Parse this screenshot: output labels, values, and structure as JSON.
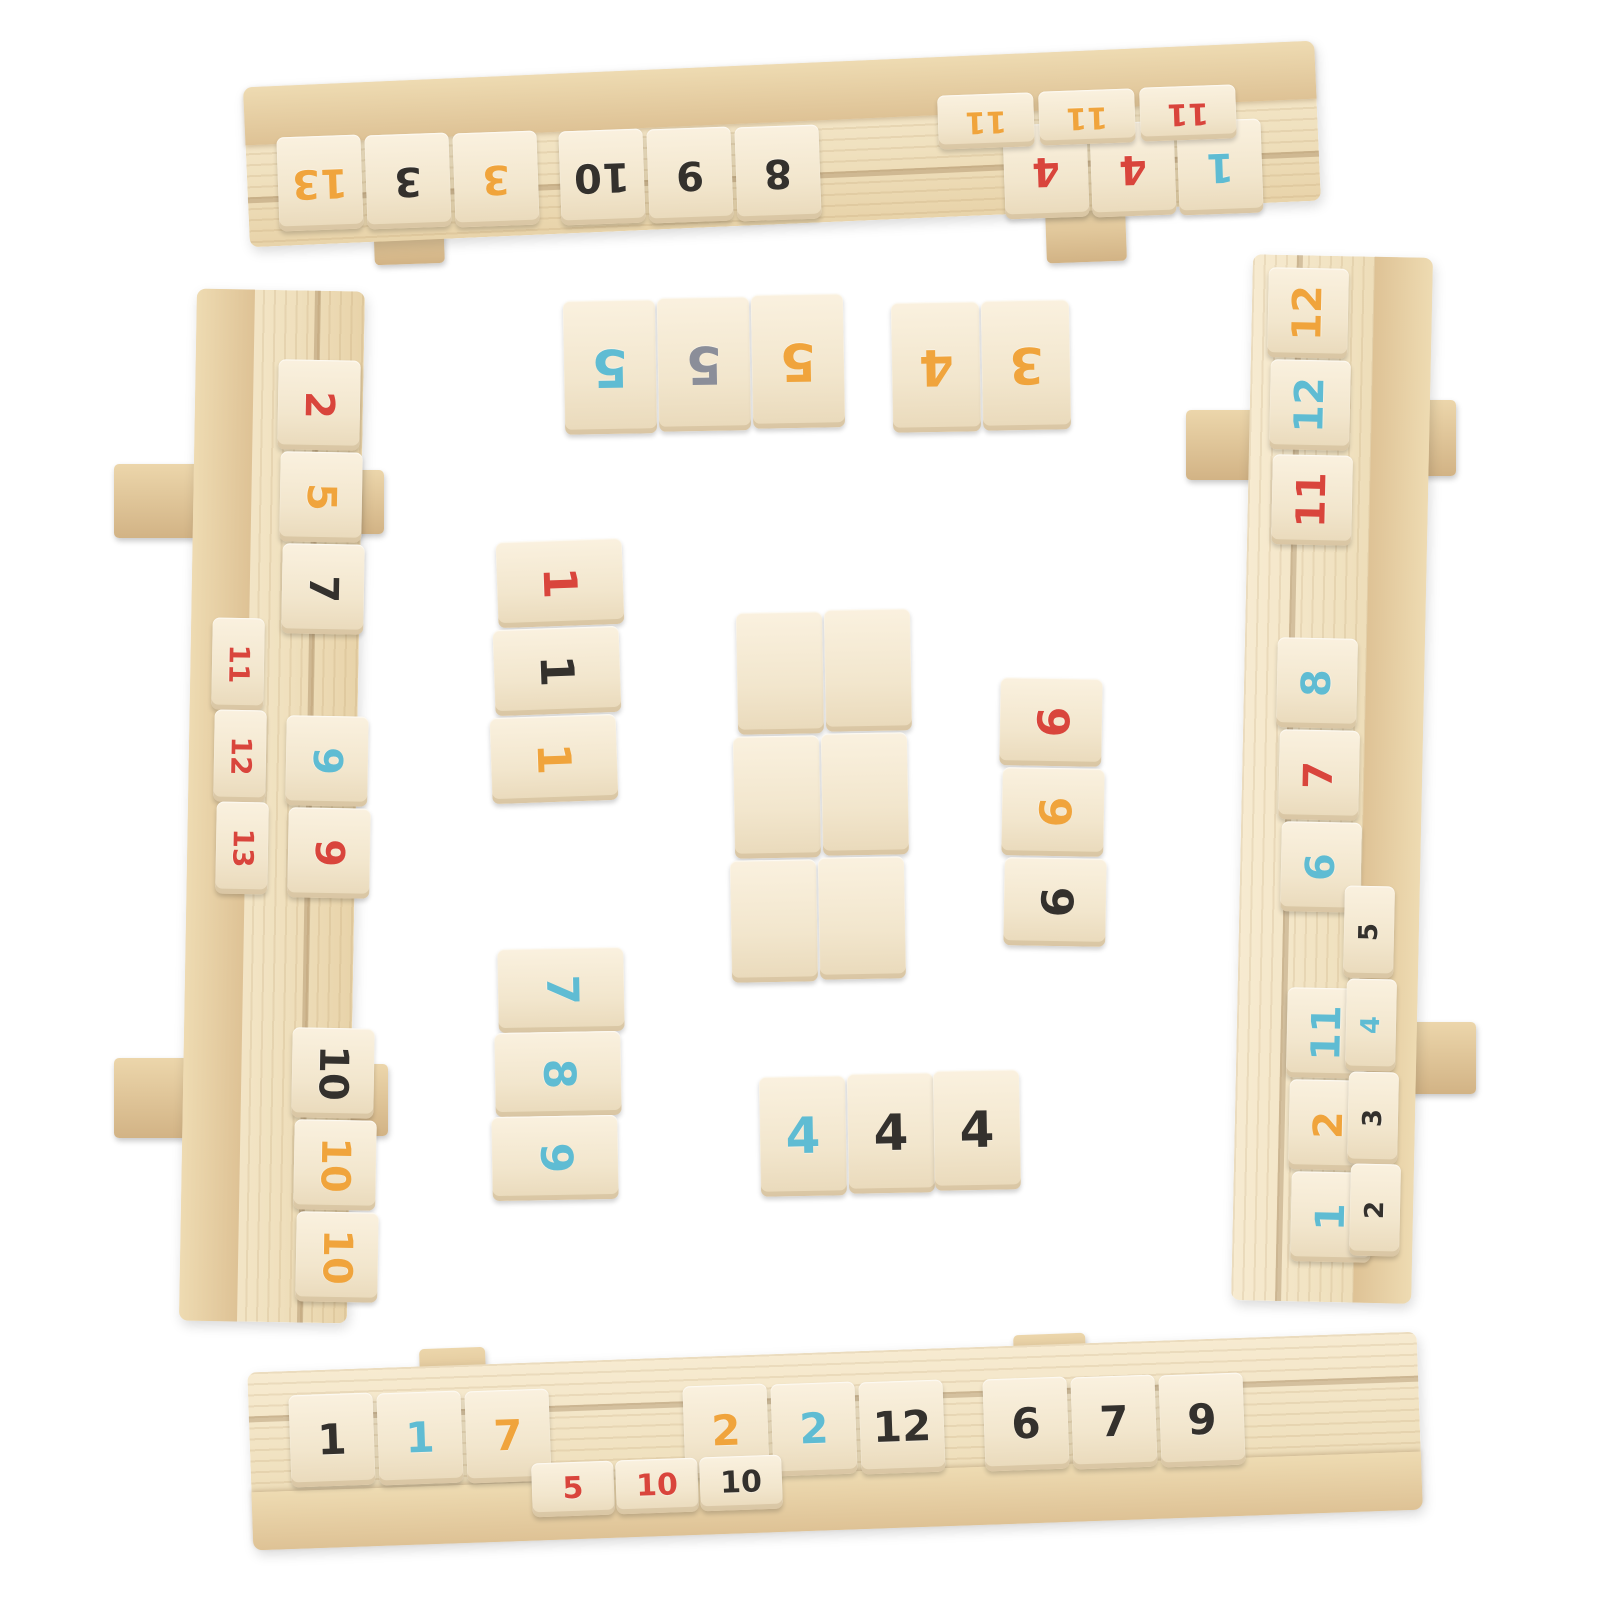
{
  "title": "Wooden Rummikub-style number tile game set - four wooden racks with colored number tiles and tile groups in the center",
  "scene": {
    "width": 1600,
    "height": 1600,
    "background": "#ffffff"
  },
  "palette": {
    "red": "#d9453c",
    "orange": "#f0a43c",
    "blue": "#5fbcd3",
    "black": "#34312d",
    "gray": "#8b8e99",
    "tile": "#f4e9d2",
    "wood": "#f0e1bf",
    "woodDark": "#dec295"
  },
  "boards": [
    {
      "name": "top-rack",
      "kind": "ht",
      "x": 246,
      "y": 64,
      "w": 1072,
      "h": 160,
      "rot": -2.5
    },
    {
      "name": "left-rack",
      "kind": "vl",
      "x": 188,
      "y": 290,
      "w": 168,
      "h": 1032,
      "rot": 1
    },
    {
      "name": "right-rack",
      "kind": "vr",
      "x": 1242,
      "y": 256,
      "w": 180,
      "h": 1046,
      "rot": 1.2
    },
    {
      "name": "bottom-rack",
      "kind": "hb",
      "x": 250,
      "y": 1352,
      "w": 1170,
      "h": 178,
      "rot": -2
    }
  ],
  "feet": [
    [
      374,
      216,
      70,
      48,
      -2
    ],
    [
      1046,
      208,
      80,
      54,
      -2
    ],
    [
      114,
      464,
      86,
      74,
      0
    ],
    [
      352,
      470,
      32,
      64,
      0
    ],
    [
      114,
      1058,
      84,
      80,
      0
    ],
    [
      344,
      1064,
      44,
      72,
      0
    ],
    [
      1186,
      410,
      80,
      70,
      0
    ],
    [
      1404,
      400,
      52,
      76,
      0
    ],
    [
      1404,
      1022,
      72,
      72,
      0
    ],
    [
      420,
      1348,
      66,
      60,
      -2
    ],
    [
      1014,
      1334,
      72,
      54,
      -2
    ]
  ],
  "tileGroups": [
    {
      "name": "top-rack-row",
      "w": 84,
      "h": 94,
      "rot": -2,
      "numRot": 180,
      "fontSize": 40,
      "tiles": [
        [
          "13",
          "orange",
          278,
          136
        ],
        [
          "3",
          "black",
          366,
          134
        ],
        [
          "3",
          "orange",
          454,
          132
        ],
        [
          "10",
          "black",
          560,
          130
        ],
        [
          "9",
          "black",
          648,
          128
        ],
        [
          "8",
          "black",
          736,
          126
        ],
        [
          "4",
          "red",
          1004,
          124
        ],
        [
          "4",
          "red",
          1091,
          122
        ],
        [
          "1",
          "blue",
          1178,
          120
        ]
      ]
    },
    {
      "name": "top-rack-ledge",
      "w": 96,
      "h": 54,
      "rot": -2,
      "numRot": 180,
      "fontSize": 30,
      "tiles": [
        [
          "11",
          "orange",
          938,
          94
        ],
        [
          "11",
          "orange",
          1039,
          90
        ],
        [
          "11",
          "red",
          1140,
          86
        ]
      ]
    },
    {
      "name": "left-rack-row",
      "w": 82,
      "h": 90,
      "rot": 1,
      "numRot": 90,
      "fontSize": 40,
      "tiles": [
        [
          "2",
          "red",
          278,
          360
        ],
        [
          "5",
          "orange",
          280,
          452
        ],
        [
          "7",
          "black",
          282,
          544
        ],
        [
          "9",
          "blue",
          286,
          716
        ],
        [
          "9",
          "red",
          288,
          808
        ],
        [
          "10",
          "black",
          292,
          1028
        ],
        [
          "10",
          "orange",
          294,
          1120
        ],
        [
          "10",
          "orange",
          296,
          1212
        ]
      ]
    },
    {
      "name": "left-rack-side",
      "w": 52,
      "h": 92,
      "rot": 1,
      "numRot": 90,
      "fontSize": 28,
      "tiles": [
        [
          "11",
          "red",
          212,
          618
        ],
        [
          "12",
          "red",
          214,
          710
        ],
        [
          "13",
          "red",
          216,
          802
        ]
      ]
    },
    {
      "name": "right-rack-row",
      "w": 80,
      "h": 90,
      "rot": 1.2,
      "numRot": -90,
      "fontSize": 40,
      "tiles": [
        [
          "12",
          "orange",
          1268,
          268
        ],
        [
          "12",
          "blue",
          1270,
          360
        ],
        [
          "11",
          "red",
          1272,
          455
        ],
        [
          "8",
          "blue",
          1277,
          638
        ],
        [
          "7",
          "red",
          1279,
          730
        ],
        [
          "6",
          "blue",
          1281,
          822
        ],
        [
          "11",
          "blue",
          1287,
          988
        ],
        [
          "2",
          "orange",
          1289,
          1080
        ],
        [
          "1",
          "blue",
          1291,
          1172
        ]
      ]
    },
    {
      "name": "right-rack-side",
      "w": 50,
      "h": 92,
      "rot": 1.2,
      "numRot": -90,
      "fontSize": 26,
      "tiles": [
        [
          "5",
          "black",
          1344,
          886
        ],
        [
          "4",
          "blue",
          1346,
          979
        ],
        [
          "3",
          "black",
          1348,
          1072
        ],
        [
          "2",
          "black",
          1350,
          1164
        ]
      ]
    },
    {
      "name": "bottom-rack-row",
      "w": 84,
      "h": 92,
      "rot": -2,
      "numRot": 0,
      "fontSize": 42,
      "tiles": [
        [
          "1",
          "black",
          290,
          1394
        ],
        [
          "1",
          "blue",
          378,
          1392
        ],
        [
          "7",
          "orange",
          466,
          1390
        ],
        [
          "2",
          "orange",
          684,
          1385
        ],
        [
          "2",
          "blue",
          772,
          1383
        ],
        [
          "12",
          "black",
          860,
          1381
        ],
        [
          "6",
          "black",
          984,
          1378
        ],
        [
          "7",
          "black",
          1072,
          1376
        ],
        [
          "9",
          "black",
          1160,
          1374
        ]
      ]
    },
    {
      "name": "bottom-rack-ledge",
      "w": 82,
      "h": 54,
      "rot": -2,
      "numRot": 0,
      "fontSize": 30,
      "tiles": [
        [
          "5",
          "red",
          532,
          1462
        ],
        [
          "10",
          "red",
          616,
          1459
        ],
        [
          "10",
          "black",
          700,
          1456
        ]
      ]
    },
    {
      "name": "center-group-fives",
      "w": 92,
      "h": 134,
      "rot": -1,
      "numRot": 180,
      "fontSize": 52,
      "tiles": [
        [
          "5",
          "blue",
          564,
          300
        ],
        [
          "5",
          "gray",
          658,
          297
        ],
        [
          "5",
          "orange",
          752,
          294
        ]
      ]
    },
    {
      "name": "center-group-four-three",
      "w": 88,
      "h": 130,
      "rot": -1,
      "numRot": 180,
      "fontSize": 50,
      "tiles": [
        [
          "4",
          "orange",
          892,
          302
        ],
        [
          "3",
          "orange",
          982,
          300
        ]
      ]
    },
    {
      "name": "center-group-ones",
      "w": 126,
      "h": 86,
      "rot": -2,
      "numRot": 90,
      "fontSize": 46,
      "tiles": [
        [
          "1",
          "red",
          497,
          540
        ],
        [
          "1",
          "black",
          494,
          628
        ],
        [
          "1",
          "orange",
          491,
          716
        ]
      ]
    },
    {
      "name": "center-group-blank",
      "w": 86,
      "h": 122,
      "rot": -1,
      "numRot": 0,
      "fontSize": 0,
      "tiles": [
        [
          "",
          "black",
          737,
          612
        ],
        [
          "",
          "black",
          825,
          609
        ],
        [
          "",
          "black",
          734,
          736
        ],
        [
          "",
          "black",
          822,
          733
        ],
        [
          "",
          "black",
          731,
          860
        ],
        [
          "",
          "black",
          819,
          857
        ]
      ]
    },
    {
      "name": "center-group-nines",
      "w": 102,
      "h": 88,
      "rot": 1,
      "numRot": 90,
      "fontSize": 44,
      "tiles": [
        [
          "9",
          "red",
          1000,
          678
        ],
        [
          "9",
          "orange",
          1002,
          768
        ],
        [
          "9",
          "black",
          1004,
          858
        ]
      ]
    },
    {
      "name": "center-group-seven-eight-nine",
      "w": 126,
      "h": 84,
      "rot": -1,
      "numRot": 90,
      "fontSize": 44,
      "tiles": [
        [
          "7",
          "blue",
          498,
          948
        ],
        [
          "8",
          "blue",
          495,
          1032
        ],
        [
          "9",
          "blue",
          492,
          1116
        ]
      ]
    },
    {
      "name": "center-group-fours",
      "w": 86,
      "h": 120,
      "rot": -1,
      "numRot": 0,
      "fontSize": 50,
      "tiles": [
        [
          "4",
          "blue",
          760,
          1076
        ],
        [
          "4",
          "black",
          848,
          1073
        ],
        [
          "4",
          "black",
          934,
          1070
        ]
      ]
    }
  ]
}
